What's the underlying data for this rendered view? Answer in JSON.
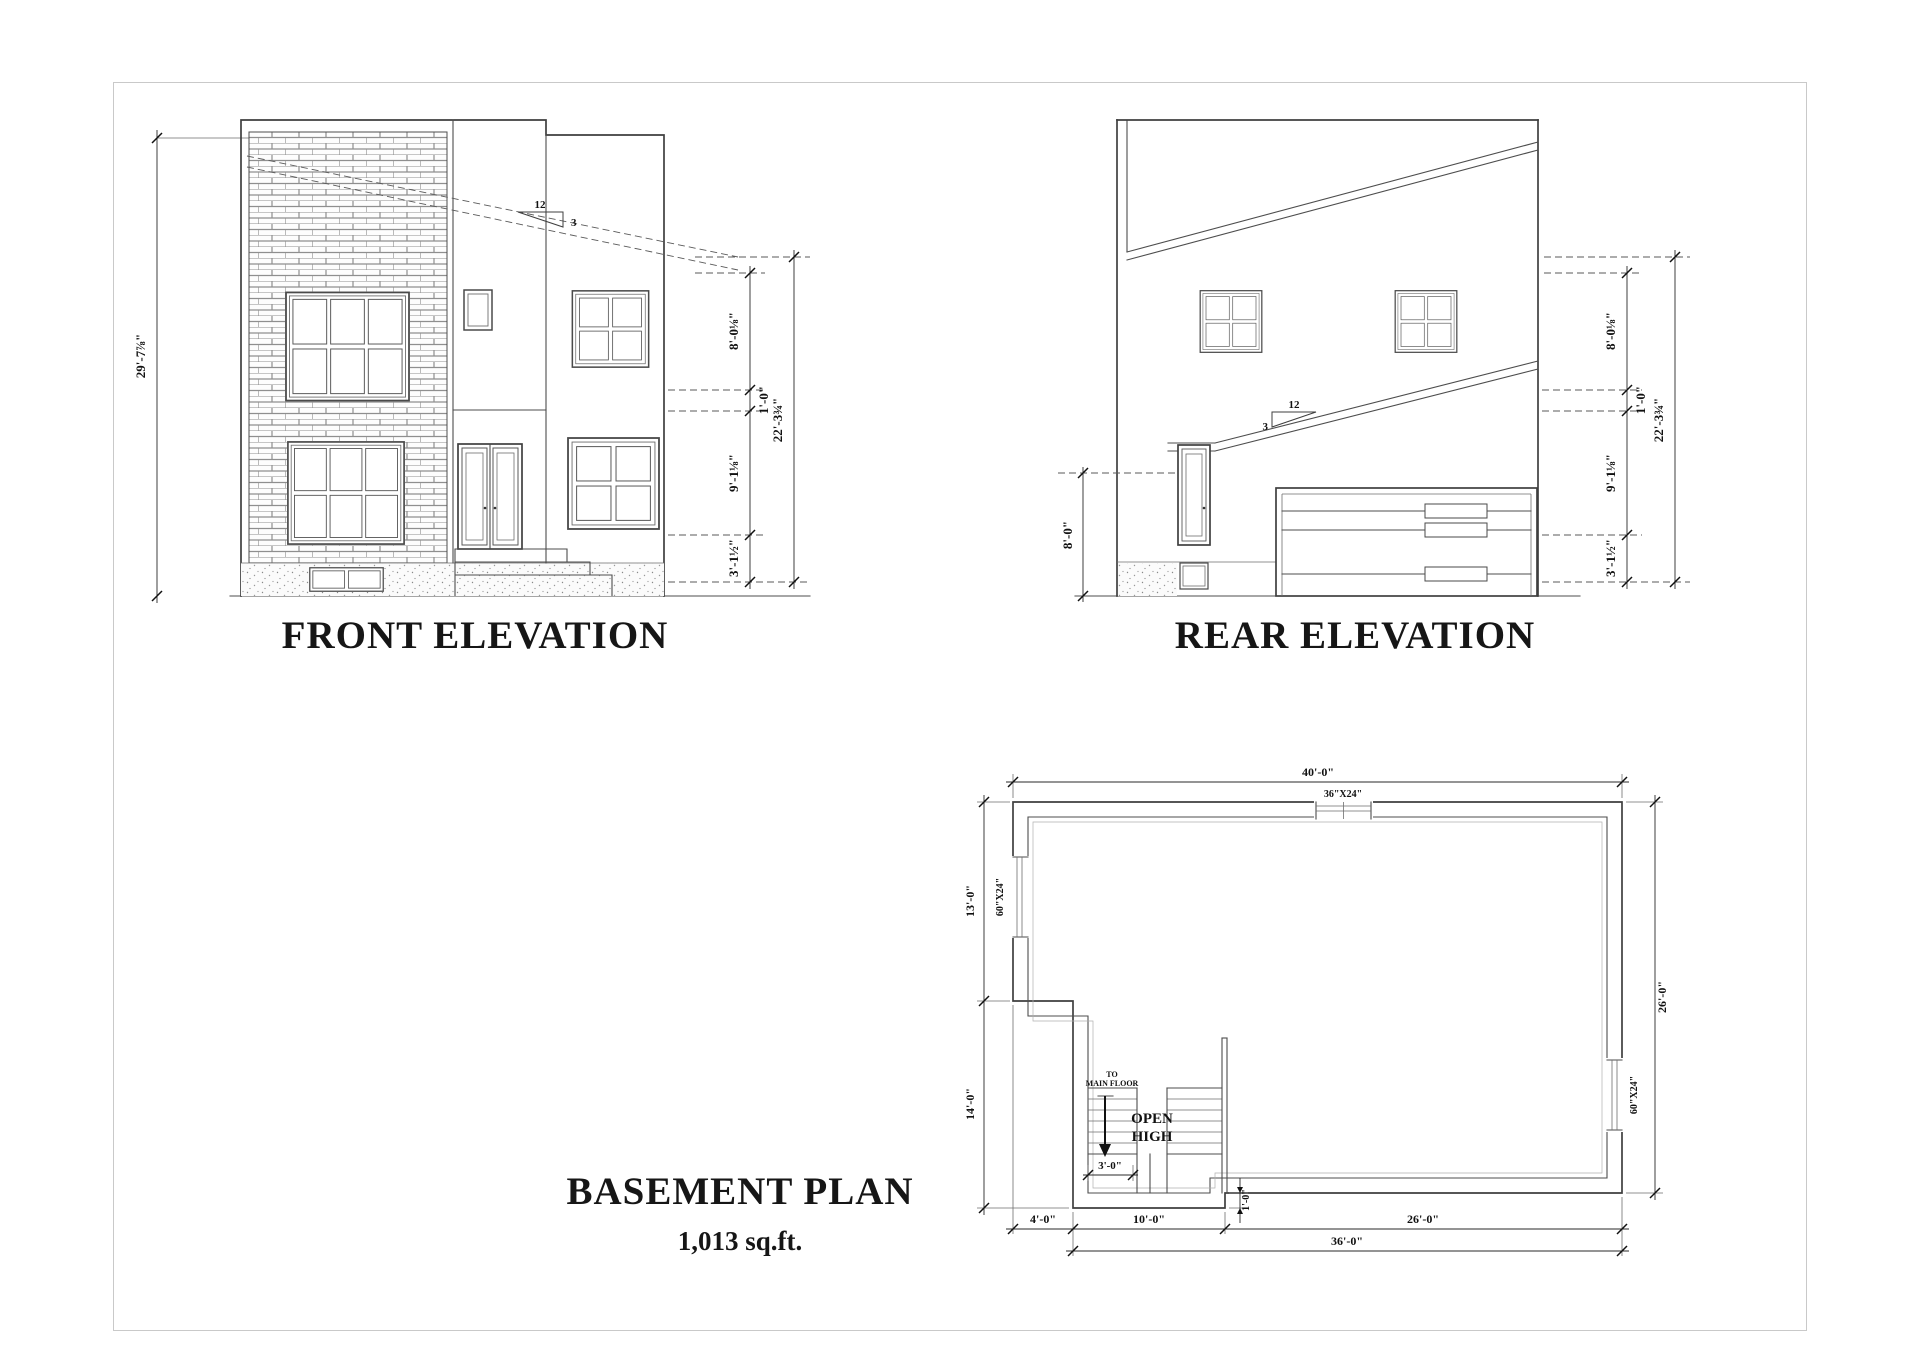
{
  "titles": {
    "front": "FRONT ELEVATION",
    "rear": "REAR ELEVATION",
    "basement": "BASEMENT PLAN",
    "basement_area": "1,013 sq.ft."
  },
  "front_elevation": {
    "overall_height": "29'-7⅞\"",
    "roof_slope": {
      "rise": "12",
      "run": "3"
    },
    "right_dims": {
      "upper_floor": "8'-0⅛\"",
      "floor_depth": "1'-0\"",
      "main_floor": "9'-1⅛\"",
      "foundation": "3'-1½\"",
      "overall": "22'-3¾\""
    }
  },
  "rear_elevation": {
    "door_height": "8'-0\"",
    "roof_slope": {
      "rise": "12",
      "run": "3"
    },
    "right_dims": {
      "upper_floor": "8'-0⅛\"",
      "floor_depth": "1'-0\"",
      "main_floor": "9'-1⅛\"",
      "foundation": "3'-1½\"",
      "overall": "22'-3¾\""
    }
  },
  "basement_plan": {
    "dims": {
      "width_overall": "40'-0\"",
      "depth_overall": "26'-0\"",
      "left_upper": "13'-0\"",
      "left_lower": "14'-0\"",
      "bottom_seg1": "4'-0\"",
      "bottom_seg2": "10'-0\"",
      "bottom_seg3": "26'-0\"",
      "bottom_overall": "36'-0\"",
      "stair_width": "3'-0\"",
      "wall_offset": "1'-0\""
    },
    "windows": {
      "top": "36\"X24\"",
      "left": "60\"X24\"",
      "right": "60\"X24\""
    },
    "stairs": {
      "to_line1": "TO",
      "to_line2": "MAIN FLOOR",
      "open_line1": "OPEN",
      "open_line2": "HIGH"
    }
  }
}
